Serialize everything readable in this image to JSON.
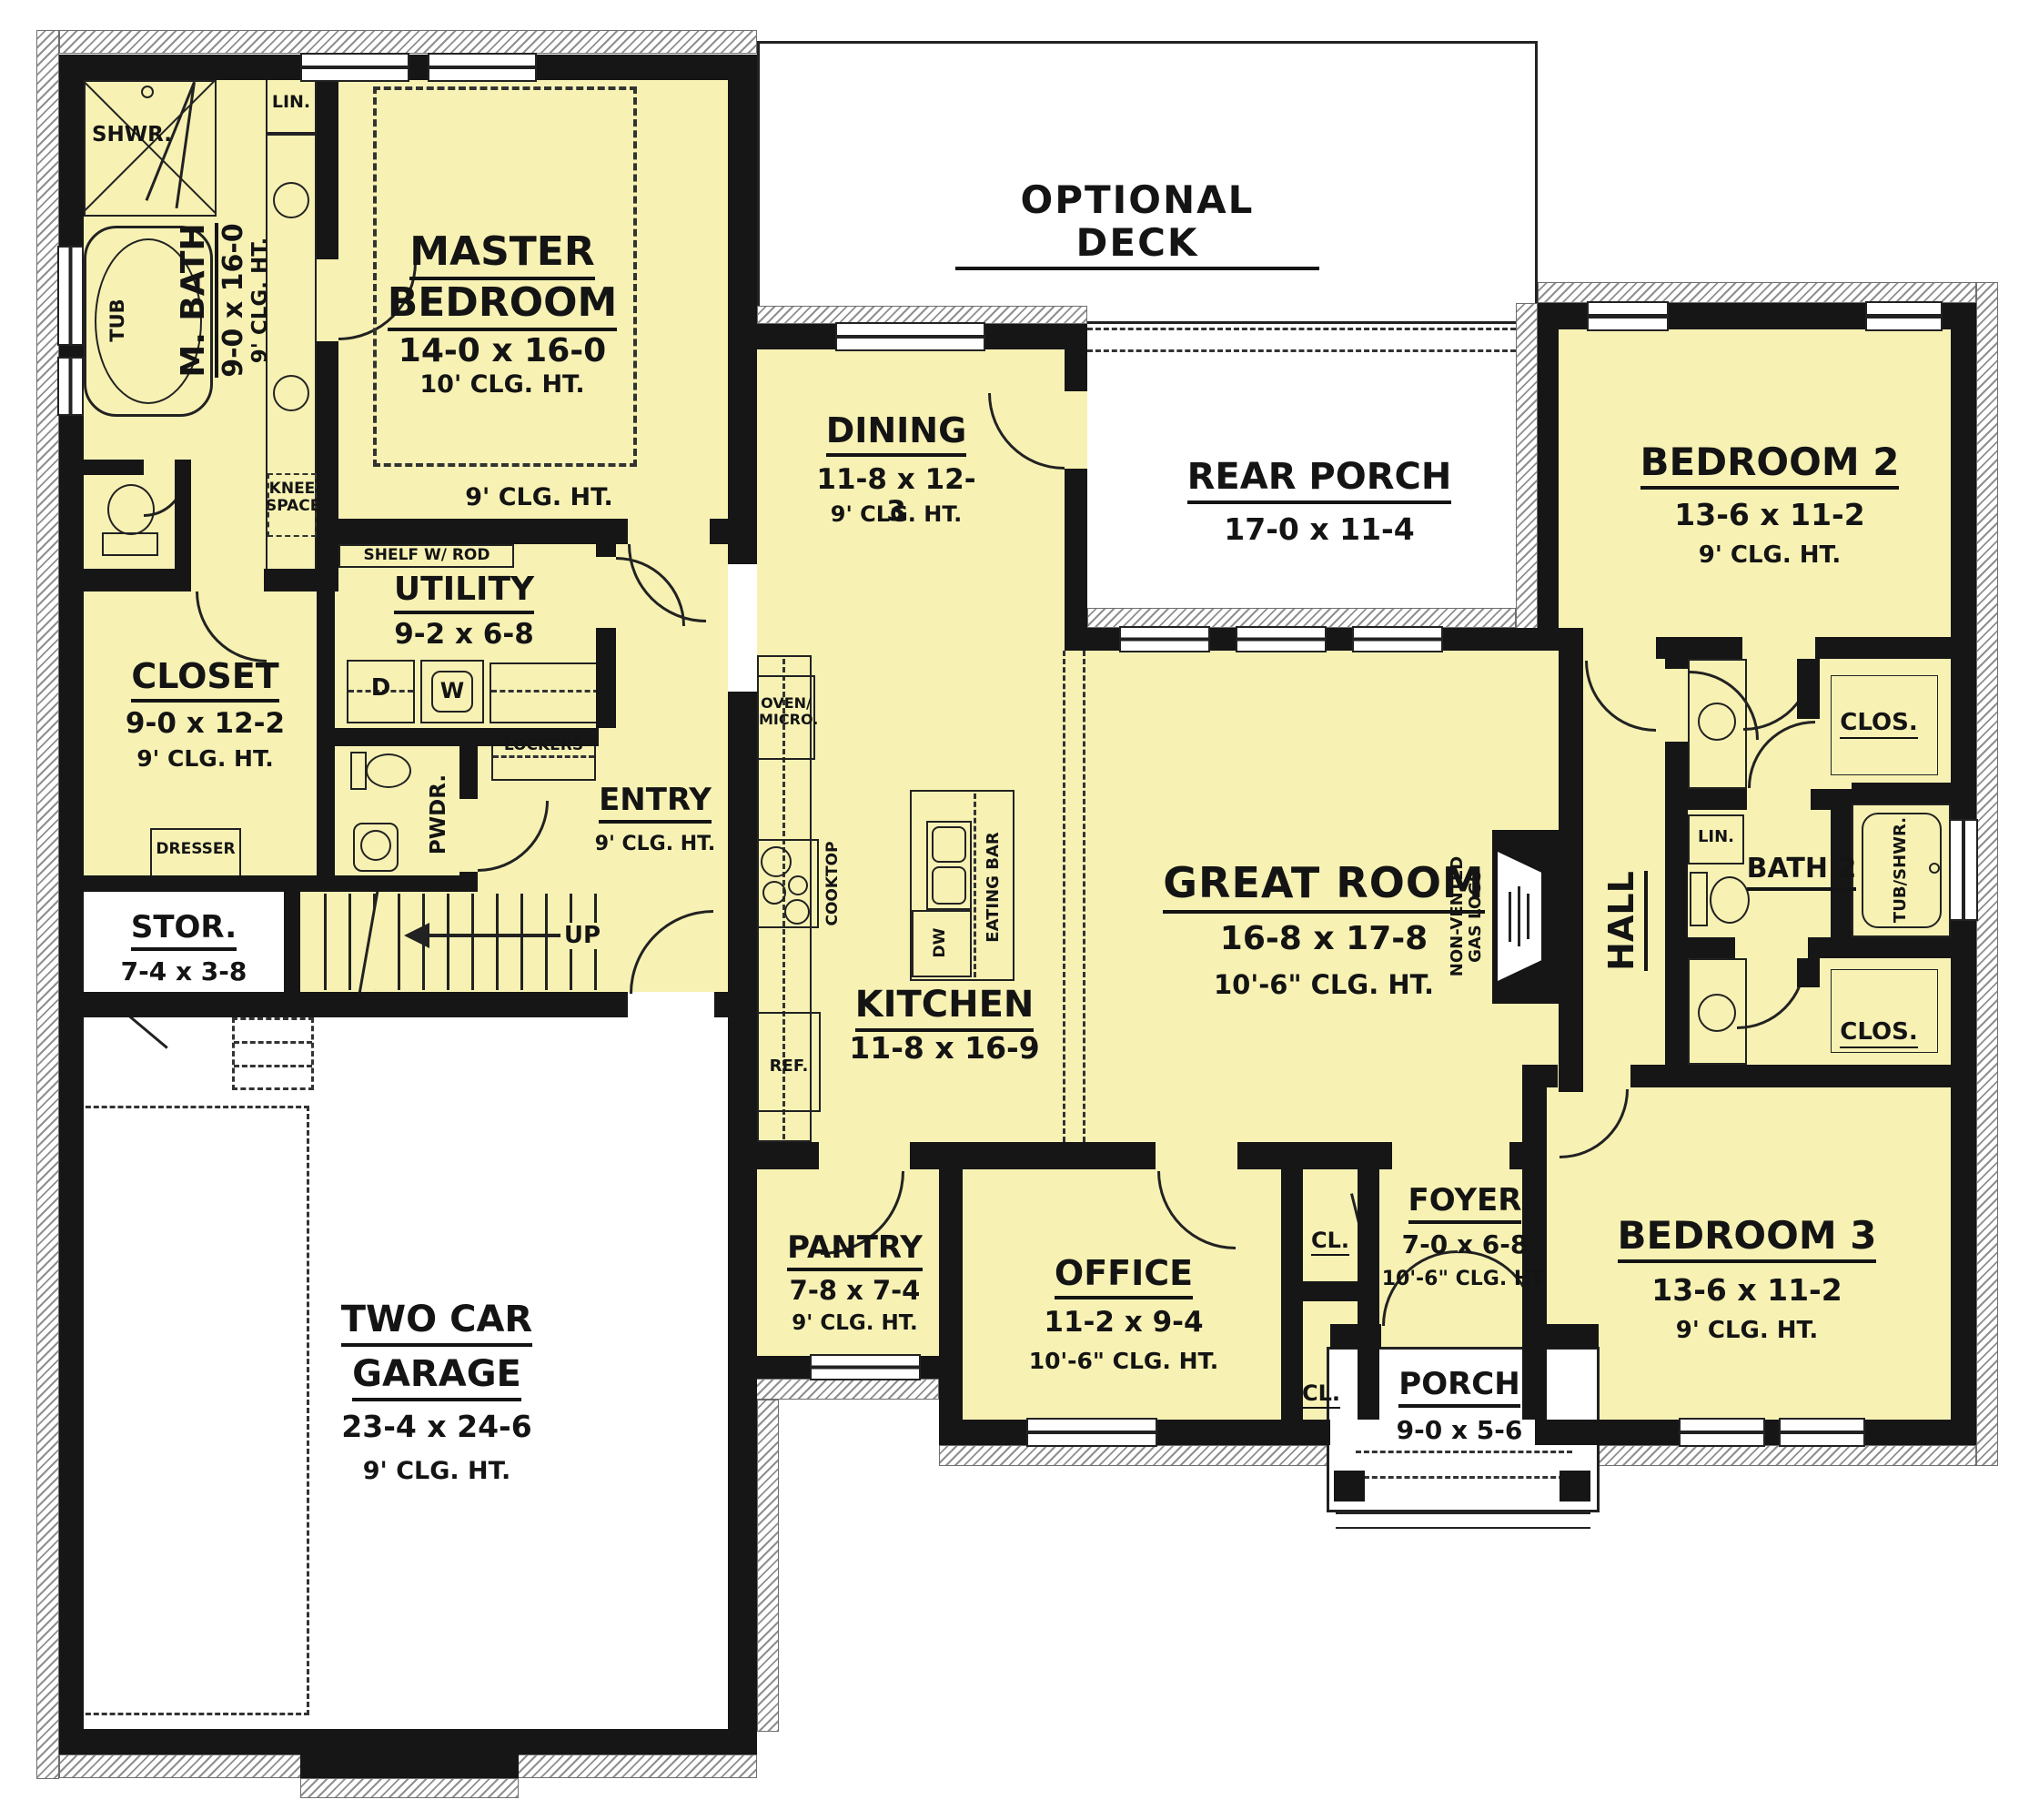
{
  "deck_label": "OPTIONAL DECK",
  "rooms": {
    "master": {
      "line1": "MASTER",
      "line2": "BEDROOM",
      "dims": "14-0 x 16-0",
      "clg": "10' CLG. HT.",
      "clg_outer": "9' CLG. HT."
    },
    "mbath": {
      "name": "M. BATH",
      "dims": "9-0 x 16-0",
      "clg": "9' CLG. HT."
    },
    "closet": {
      "name": "CLOSET",
      "dims": "9-0 x 12-2",
      "clg": "9' CLG. HT."
    },
    "utility": {
      "name": "UTILITY",
      "dims": "9-2 x 6-8"
    },
    "stor": {
      "name": "STOR.",
      "dims": "7-4 x 3-8"
    },
    "entry": {
      "name": "ENTRY",
      "clg": "9' CLG. HT."
    },
    "garage": {
      "line1": "TWO CAR",
      "line2": "GARAGE",
      "dims": "23-4 x 24-6",
      "clg": "9' CLG. HT."
    },
    "dining": {
      "name": "DINING",
      "dims": "11-8 x 12-3",
      "clg": "9' CLG. HT."
    },
    "kitchen": {
      "name": "KITCHEN",
      "dims": "11-8 x 16-9"
    },
    "pantry": {
      "name": "PANTRY",
      "dims": "7-8 x 7-4",
      "clg": "9' CLG. HT."
    },
    "office": {
      "name": "OFFICE",
      "dims": "11-2 x 9-4",
      "clg": "10'-6\" CLG. HT."
    },
    "great": {
      "name": "GREAT ROOM",
      "dims": "16-8 x 17-8",
      "clg": "10'-6\" CLG. HT."
    },
    "rear_porch": {
      "name": "REAR PORCH",
      "dims": "17-0 x 11-4"
    },
    "foyer": {
      "name": "FOYER",
      "dims": "7-0 x 6-8",
      "clg": "10'-6\" CLG. HT."
    },
    "porch": {
      "name": "PORCH",
      "dims": "9-0 x 5-6"
    },
    "bed2": {
      "name": "BEDROOM 2",
      "dims": "13-6 x 11-2",
      "clg": "9' CLG. HT."
    },
    "bed3": {
      "name": "BEDROOM 3",
      "dims": "13-6 x 11-2",
      "clg": "9' CLG. HT."
    },
    "bath2": {
      "name": "BATH 2"
    },
    "hall": {
      "name": "HALL"
    }
  },
  "fixtures": {
    "shwr": "SHWR.",
    "tub": "TUB",
    "lin": "LIN.",
    "knee1": "KNEE",
    "knee2": "SPACE",
    "shelf_rod": "SHELF W/ ROD",
    "dresser": "DRESSER",
    "pwdr": "PWDR.",
    "dryer": "D",
    "washer": "W",
    "lockers": "LOCKERS",
    "up": "UP",
    "oven1": "OVEN/",
    "oven2": "MICRO.",
    "cooktop": "COOKTOP",
    "eating_bar": "EATING BAR",
    "dw": "DW",
    "ref": "REF.",
    "gas1": "NON-VENTED",
    "gas2": "GAS LOGS",
    "tub_shwr": "TUB/SHWR.",
    "clos": "CLOS.",
    "cl": "CL."
  },
  "colors": {
    "room_fill": "#F7F2B4",
    "wall": "#161616",
    "paper": "#FFFFFF",
    "hatch_line": "#8F8F8F"
  }
}
